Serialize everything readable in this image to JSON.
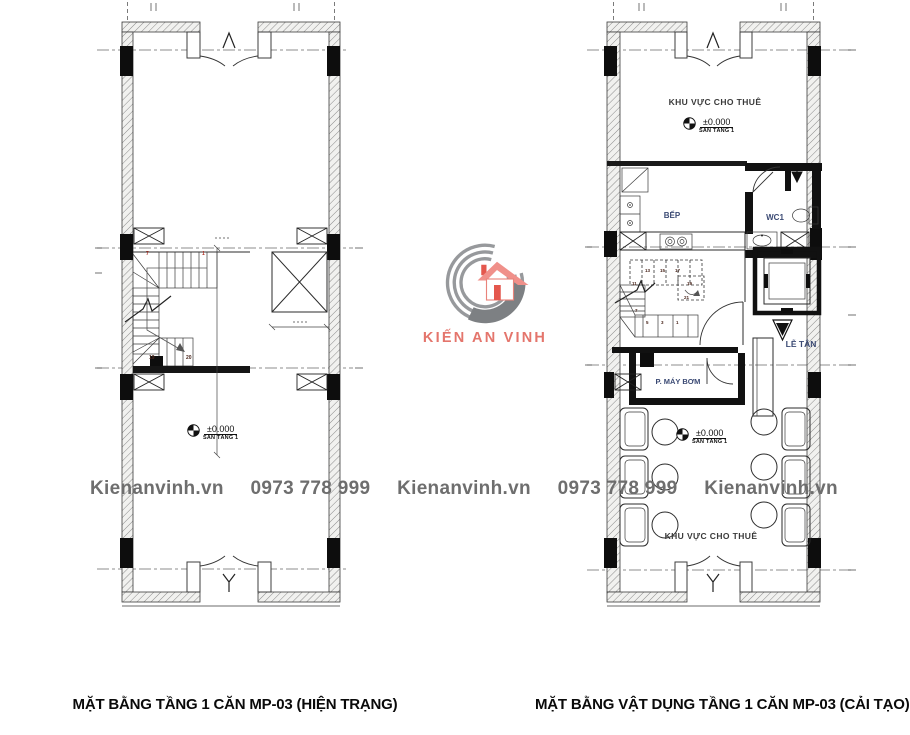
{
  "watermark": {
    "site": "Kienanvinh.vn",
    "phone": "0973 778 999",
    "color": "#6e6e6e"
  },
  "logo": {
    "brand": "KIẾN AN VINH",
    "accent_red": "#e8756b",
    "arc_gray": "#97999c",
    "swoosh_gray": "#7d8083"
  },
  "level_marker": {
    "value": "±0.000",
    "floor": "SÀN TẦNG 1"
  },
  "left_plan": {
    "title": "MẶT BẰNG TẦNG 1 CĂN MP-03 (HIỆN TRẠNG)",
    "stair_numbers": [
      "7",
      "1",
      "19",
      "20"
    ]
  },
  "right_plan": {
    "title": "MẶT BẰNG VẬT DỤNG TẦNG 1 CĂN MP-03 (CẢI TẠO)",
    "rooms": {
      "rental_top": "KHU VỰC CHO THUÊ",
      "kitchen": "BẾP",
      "wc": "WC1",
      "reception": "LỄ TÂN",
      "pump_room": "P. MÁY BƠM",
      "rental_bottom": "KHU VỰC CHO THUÊ"
    },
    "stair_numbers": [
      "13",
      "15",
      "17",
      "19",
      "21",
      "11",
      "7",
      "5",
      "3",
      "1"
    ]
  }
}
